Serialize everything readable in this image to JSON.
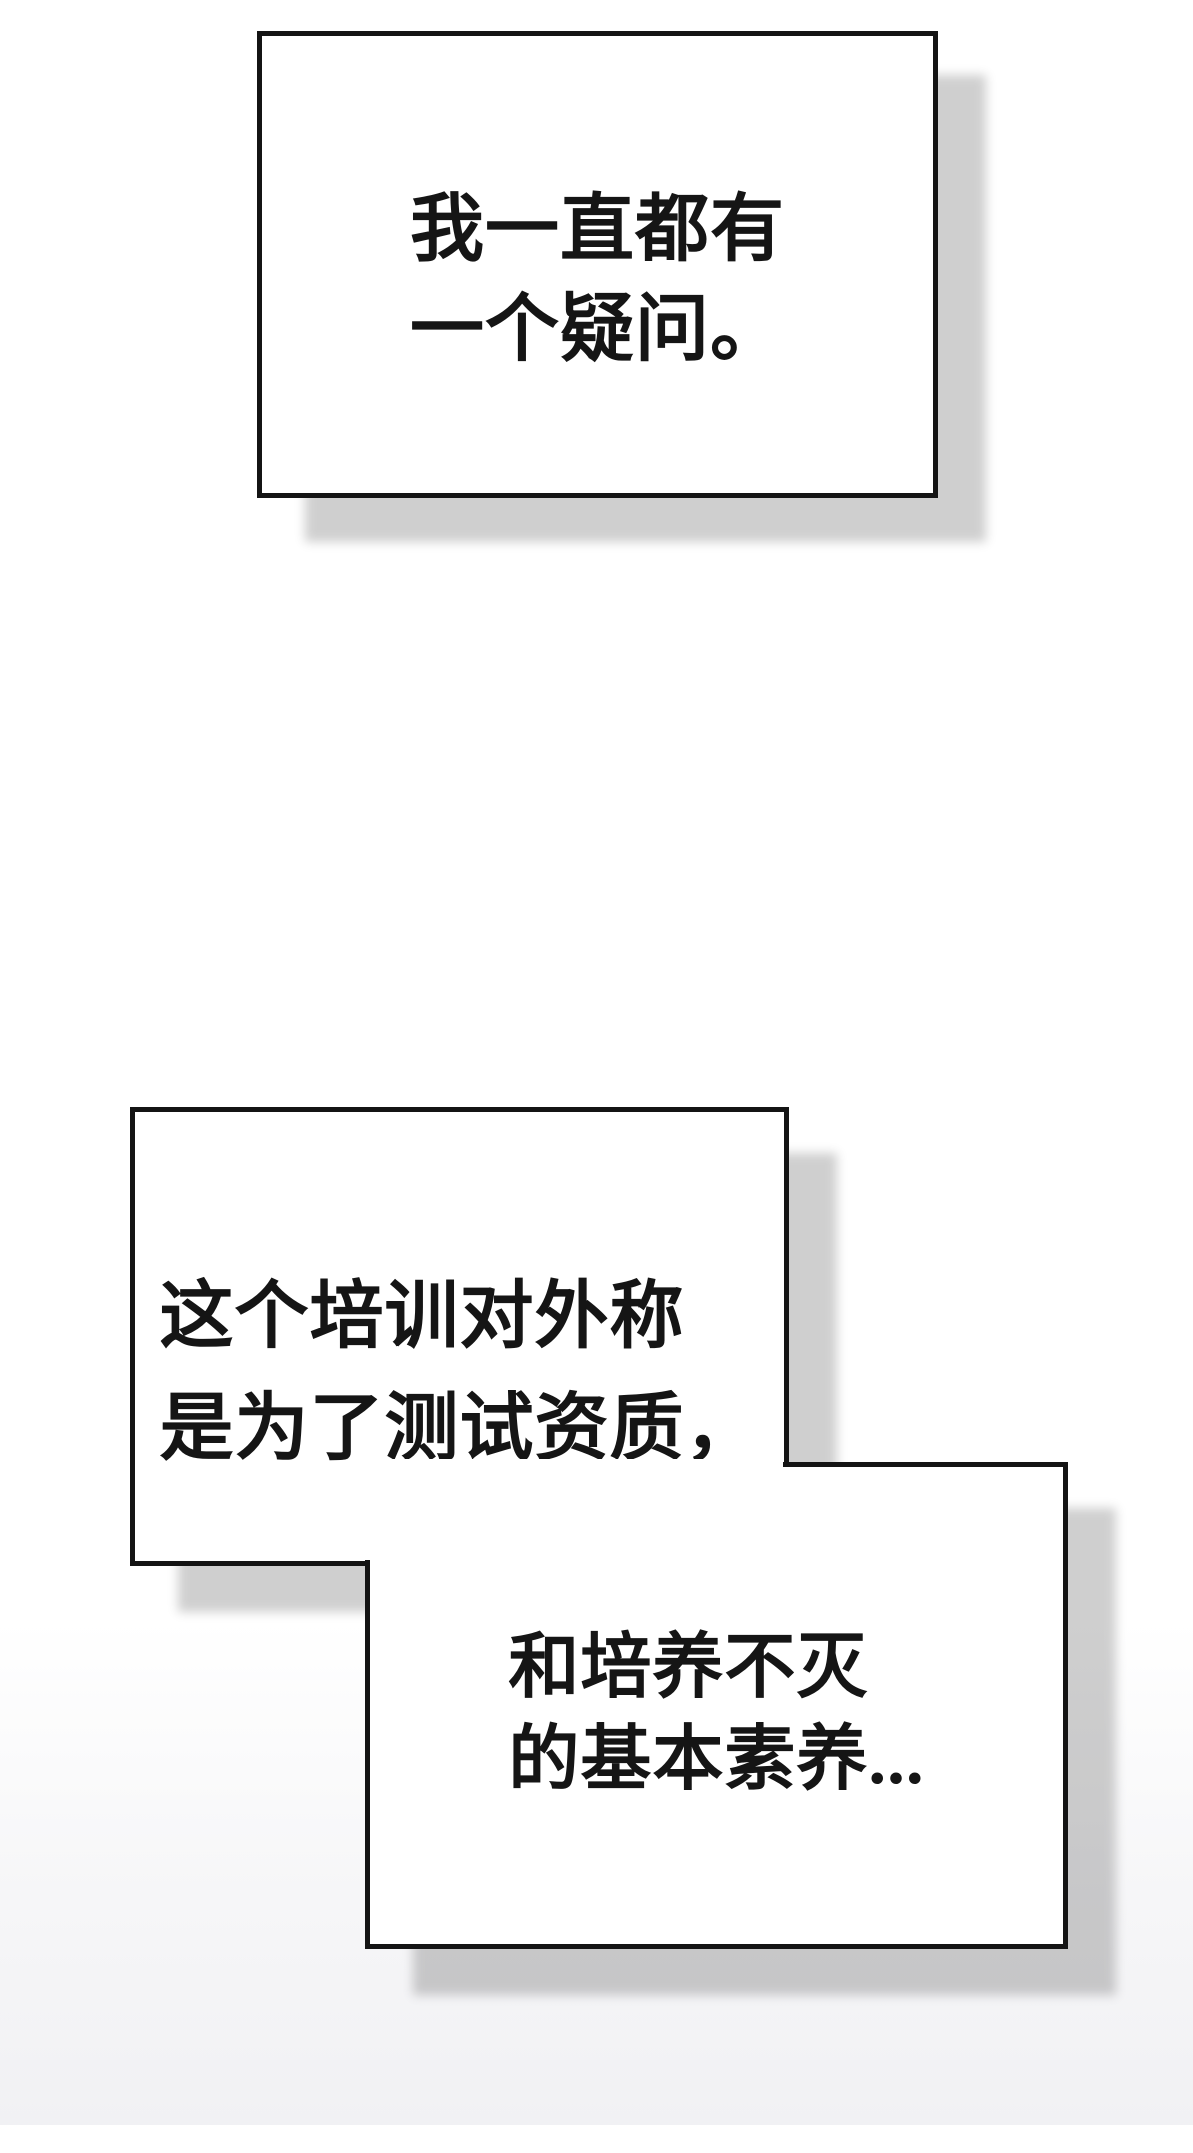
{
  "comic": {
    "bubbles": [
      {
        "id": "bubble-1",
        "lines": [
          "我一直都有",
          "一个疑问。"
        ]
      },
      {
        "id": "bubble-2",
        "lines": [
          "这个培训对外称",
          "是为了测试资质，"
        ]
      },
      {
        "id": "bubble-3",
        "lines": [
          "和培养不灭",
          "的基本素养..."
        ]
      }
    ]
  },
  "colors": {
    "page_background": "#ffffff",
    "panel_fill": "#ffffff",
    "panel_outline": "#141414",
    "text": "#151515",
    "drop_shadow": "rgba(0,0,0,0.19)",
    "bottom_wash": "#f4f4f6"
  }
}
